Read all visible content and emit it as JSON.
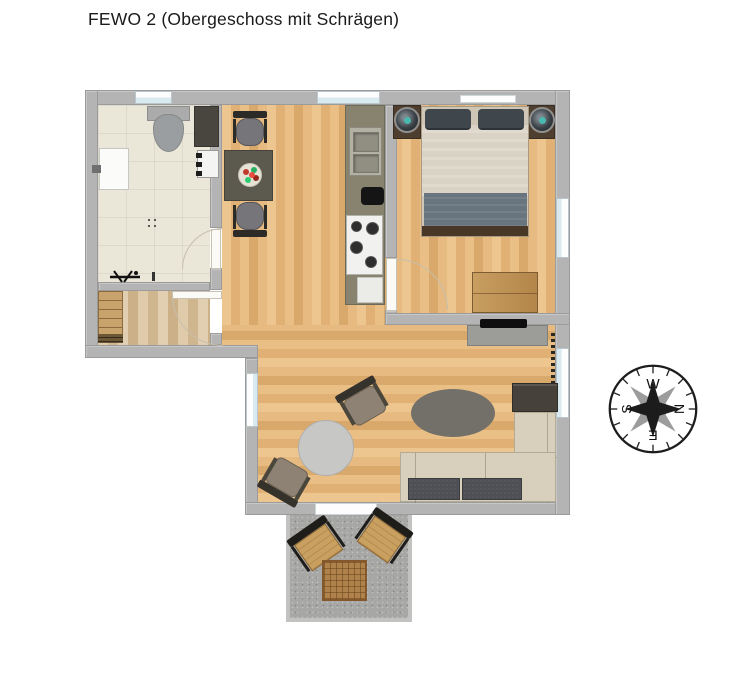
{
  "title": "FEWO 2 (Obergeschoss mit Schrägen)",
  "compass": {
    "west": "W",
    "north": "N",
    "east": "E",
    "south": "S"
  },
  "colors": {
    "text": "#1a1a1a",
    "wall": "#b4b4b4",
    "walledge": "#9b9b9b",
    "oak": "#e7bc83",
    "tile": "#eae6d8",
    "hallwood": "#d9c29f",
    "balcony": "#a7a7a5",
    "winblue": "#d9e9f0",
    "counter": "#87836f",
    "stove": "#f1f1ef",
    "tabledark": "#5c594f",
    "nightstand": "#4e3e2f",
    "accent": "#49b8af",
    "duvet": "#d9d2c5",
    "blanket": "#68757e",
    "pillow": "#3f464c",
    "sofa": "#d8d0bd",
    "sofadark": "#4e5055",
    "armchair": "#8d8274",
    "rugoval": "#73706a",
    "ruground": "#c7c7c5",
    "terracewood": "#c9a05f",
    "terracetable": "#b0824b"
  }
}
